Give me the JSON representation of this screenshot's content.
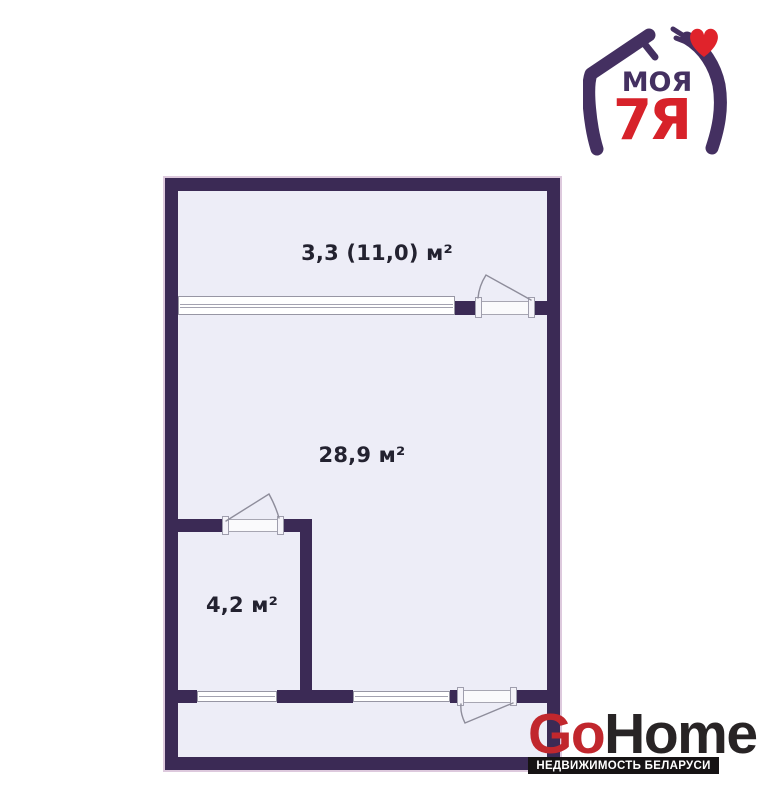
{
  "canvas": {
    "width": 762,
    "height": 800,
    "background": "#ffffff"
  },
  "colors": {
    "wall": "#3b2a55",
    "floor": "#ededf7",
    "symbol_line": "#9796a4",
    "label_text": "#232230",
    "moya_purple": "#443061",
    "moya_red": "#d7222a",
    "heart_red": "#e0232b",
    "gohome_red": "#c1272d",
    "gohome_dark": "#282425",
    "tagline_bg": "#161314",
    "tagline_text": "#ffffff"
  },
  "floorplan": {
    "rooms": [
      {
        "id": "balcony",
        "label": "3,3 (11,0) м²"
      },
      {
        "id": "living-room",
        "label": "28,9 м²"
      },
      {
        "id": "bathroom",
        "label": "4,2 м²"
      }
    ]
  },
  "logo_moya7ya": {
    "word": "МОЯ",
    "word2": "7Я"
  },
  "logo_gohome": {
    "go": "Go",
    "home": "Home",
    "tagline": "НЕДВИЖИМОСТЬ БЕЛАРУСИ"
  }
}
